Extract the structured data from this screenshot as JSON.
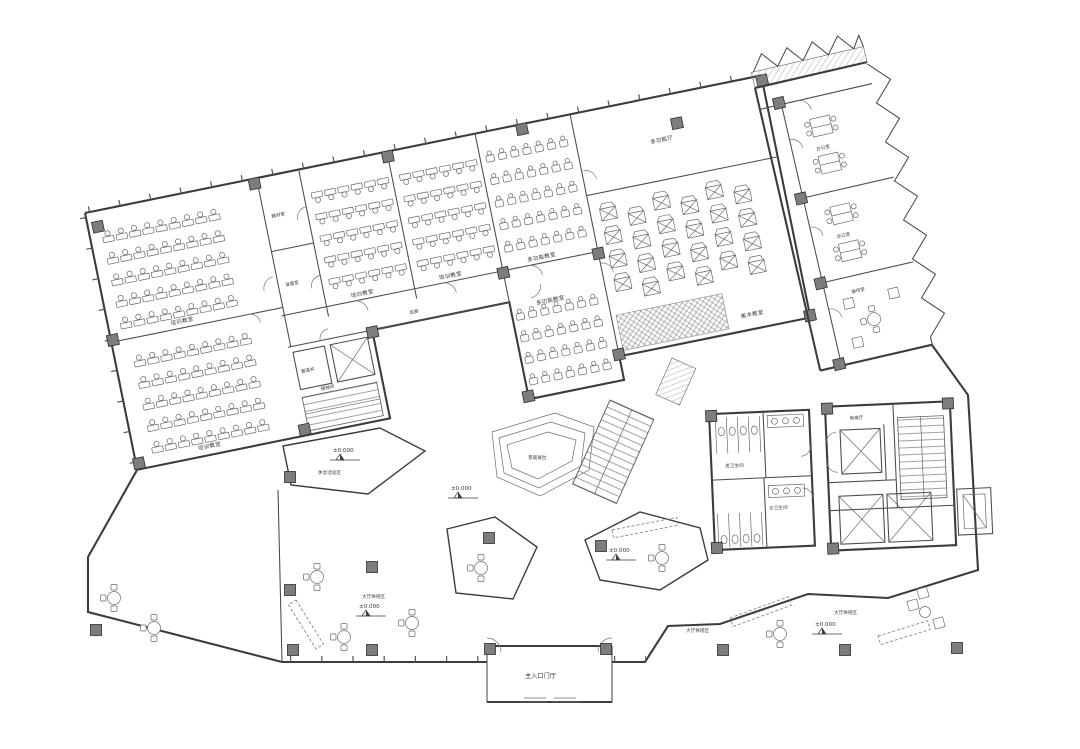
{
  "rooms": {
    "classroom": "培训教室",
    "multi": "多功能教室",
    "art": "美术教室",
    "hall_room": "多功能厅",
    "equip": "器材室",
    "prep": "准备室",
    "duct": "管道井",
    "stairwell": "楼梯间",
    "corridor": "走廊",
    "office": "办公室",
    "reception": "接待室",
    "wc_m": "男卫生间",
    "wc_f": "女卫生间",
    "elevator_hall": "电梯厅",
    "entrance": "主入口门厅",
    "lounge": "大厅休闲区",
    "rest": "休息洽谈区",
    "stage_decor": "景观展台"
  },
  "levels": {
    "zero": "±0.000"
  },
  "colors": {
    "background": "#ffffff",
    "line": "#3c3c3c",
    "furniture": "#6a6a6a",
    "column_fill": "#7d7d7d",
    "hatch": "#8a8a8a",
    "label": "#3a3a3a"
  }
}
